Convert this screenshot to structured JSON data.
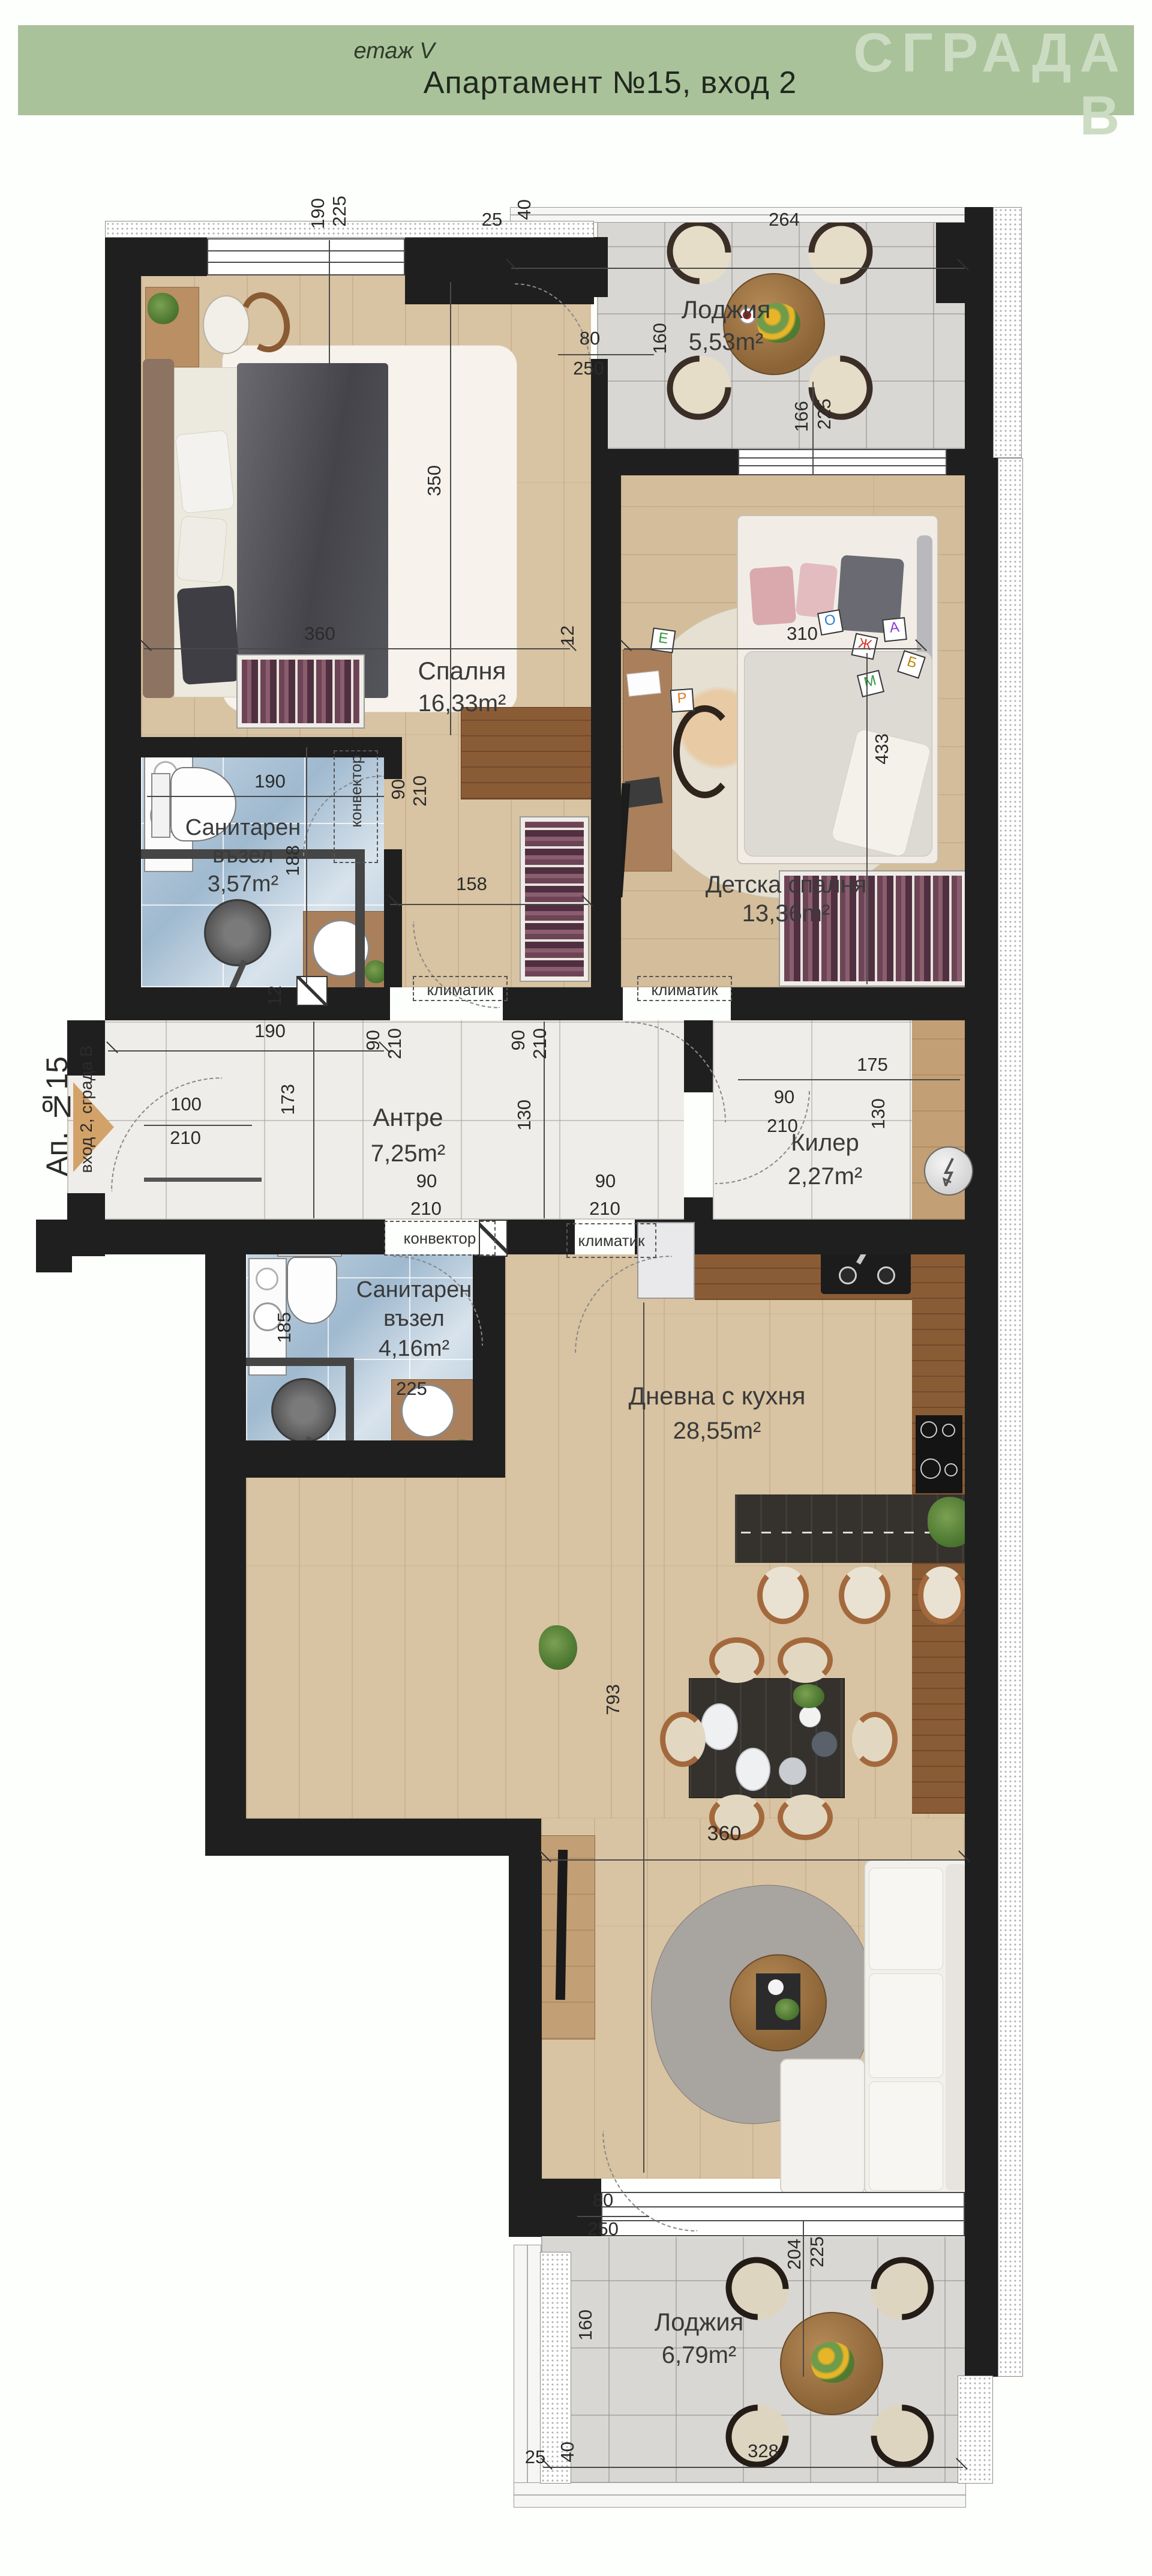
{
  "header": {
    "floor_label": "етаж V",
    "title": "Апартамент №15, вход 2",
    "building": "СГРАДА В"
  },
  "entrance": {
    "label": "Ап. №15",
    "sublabel": "вход 2, сграда В"
  },
  "rooms": {
    "loggia_top": {
      "name": "Лоджия",
      "area": "5,53m²"
    },
    "bedroom": {
      "name": "Спалня",
      "area": "16,33m²"
    },
    "bath1": {
      "name_line1": "Санитарен",
      "name_line2": "възел",
      "area": "3,57m²"
    },
    "kids": {
      "name": "Детска спалня",
      "area": "13,36m²"
    },
    "hall": {
      "name": "Антре",
      "area": "7,25m²"
    },
    "storage": {
      "name": "Килер",
      "area": "2,27m²"
    },
    "bath2": {
      "name_line1": "Санитарен",
      "name_line2": "възел",
      "area": "4,16m²"
    },
    "living": {
      "name": "Дневна с кухня",
      "area": "28,55m²"
    },
    "loggia_bottom": {
      "name": "Лоджия",
      "area": "6,79m²"
    }
  },
  "equipment": {
    "convector": "конвектор",
    "ac": "климатик"
  },
  "dims": {
    "d12": "12",
    "d25": "25",
    "d40": "40",
    "d80": "80",
    "d90": "90",
    "d100": "100",
    "d130": "130",
    "d158": "158",
    "d160": "160",
    "d166": "166",
    "d173": "173",
    "d175": "175",
    "d185": "185",
    "d188": "188",
    "d190": "190",
    "d204": "204",
    "d210": "210",
    "d225": "225",
    "d250": "250",
    "d264": "264",
    "d310": "310",
    "d328": "328",
    "d350": "350",
    "d360": "360",
    "d433": "433",
    "d793": "793"
  },
  "toy_blocks": {
    "letters": [
      "О",
      "Ж",
      "А",
      "Б",
      "М",
      "Е",
      "Р"
    ]
  },
  "colors": {
    "header_green": "#a9c29a",
    "header_text": "#2f3b2b",
    "building_text": "#ccdcc2",
    "wall": "#1f1f1f",
    "wood": "#d8c3a2",
    "wood_dark": "#8a5c36",
    "marble": "#efede9",
    "tile_blue": "#b7cdde",
    "tile_gray": "#d9d7d3",
    "entrance_arrow": "#d3a269"
  }
}
